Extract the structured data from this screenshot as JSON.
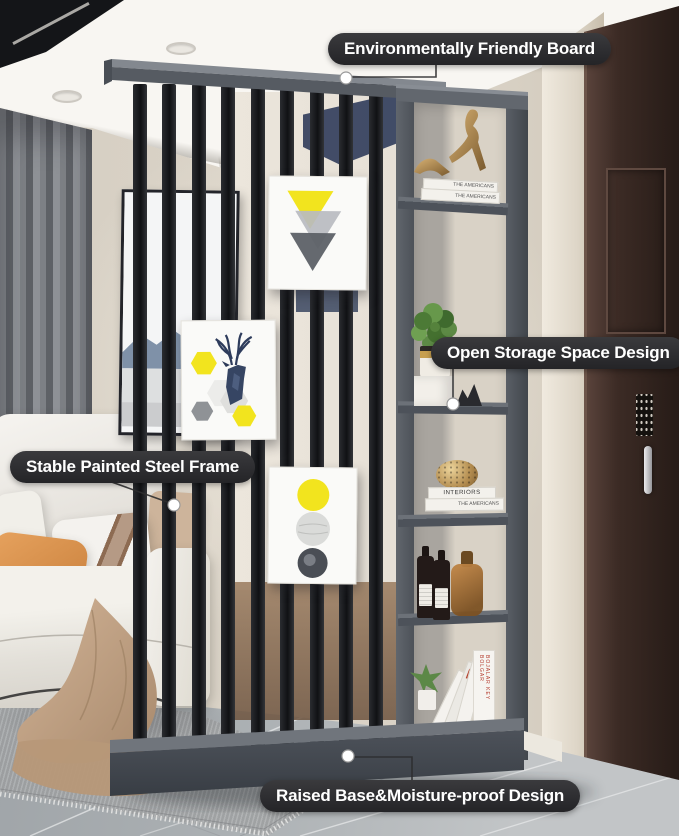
{
  "annotations": {
    "board": "Environmentally Friendly Board",
    "storage": "Open Storage Space Design",
    "frame": "Stable Painted Steel Frame",
    "base": "Raised Base&Moisture-proof Design"
  },
  "shelf": {
    "top_books": [
      "THE AMERICANS",
      "THE AMERICANS"
    ],
    "mid_books": [
      "INTERIORS",
      "THE AMERICANS"
    ],
    "bottom_book_spine": "BOJALAR KEY BOLGAR"
  },
  "colors": {
    "callout_bg": "#2a2a2c",
    "callout_text": "#ffffff",
    "accent_yellow": "#f2e41e",
    "divider_gray": "#565b62",
    "slat_black": "#17191c",
    "base_gray": "#474c52",
    "door_brown": "#3c2b25",
    "wall_beige": "#d8d1c5",
    "floor_gray": "#a3a8ac",
    "sofa_white": "#efede8",
    "pillow_orange": "#d9924f",
    "blanket_tan": "#c3a488",
    "plant_green": "#5d8a45",
    "gold": "#b3905c",
    "navy_art": "#364563"
  }
}
